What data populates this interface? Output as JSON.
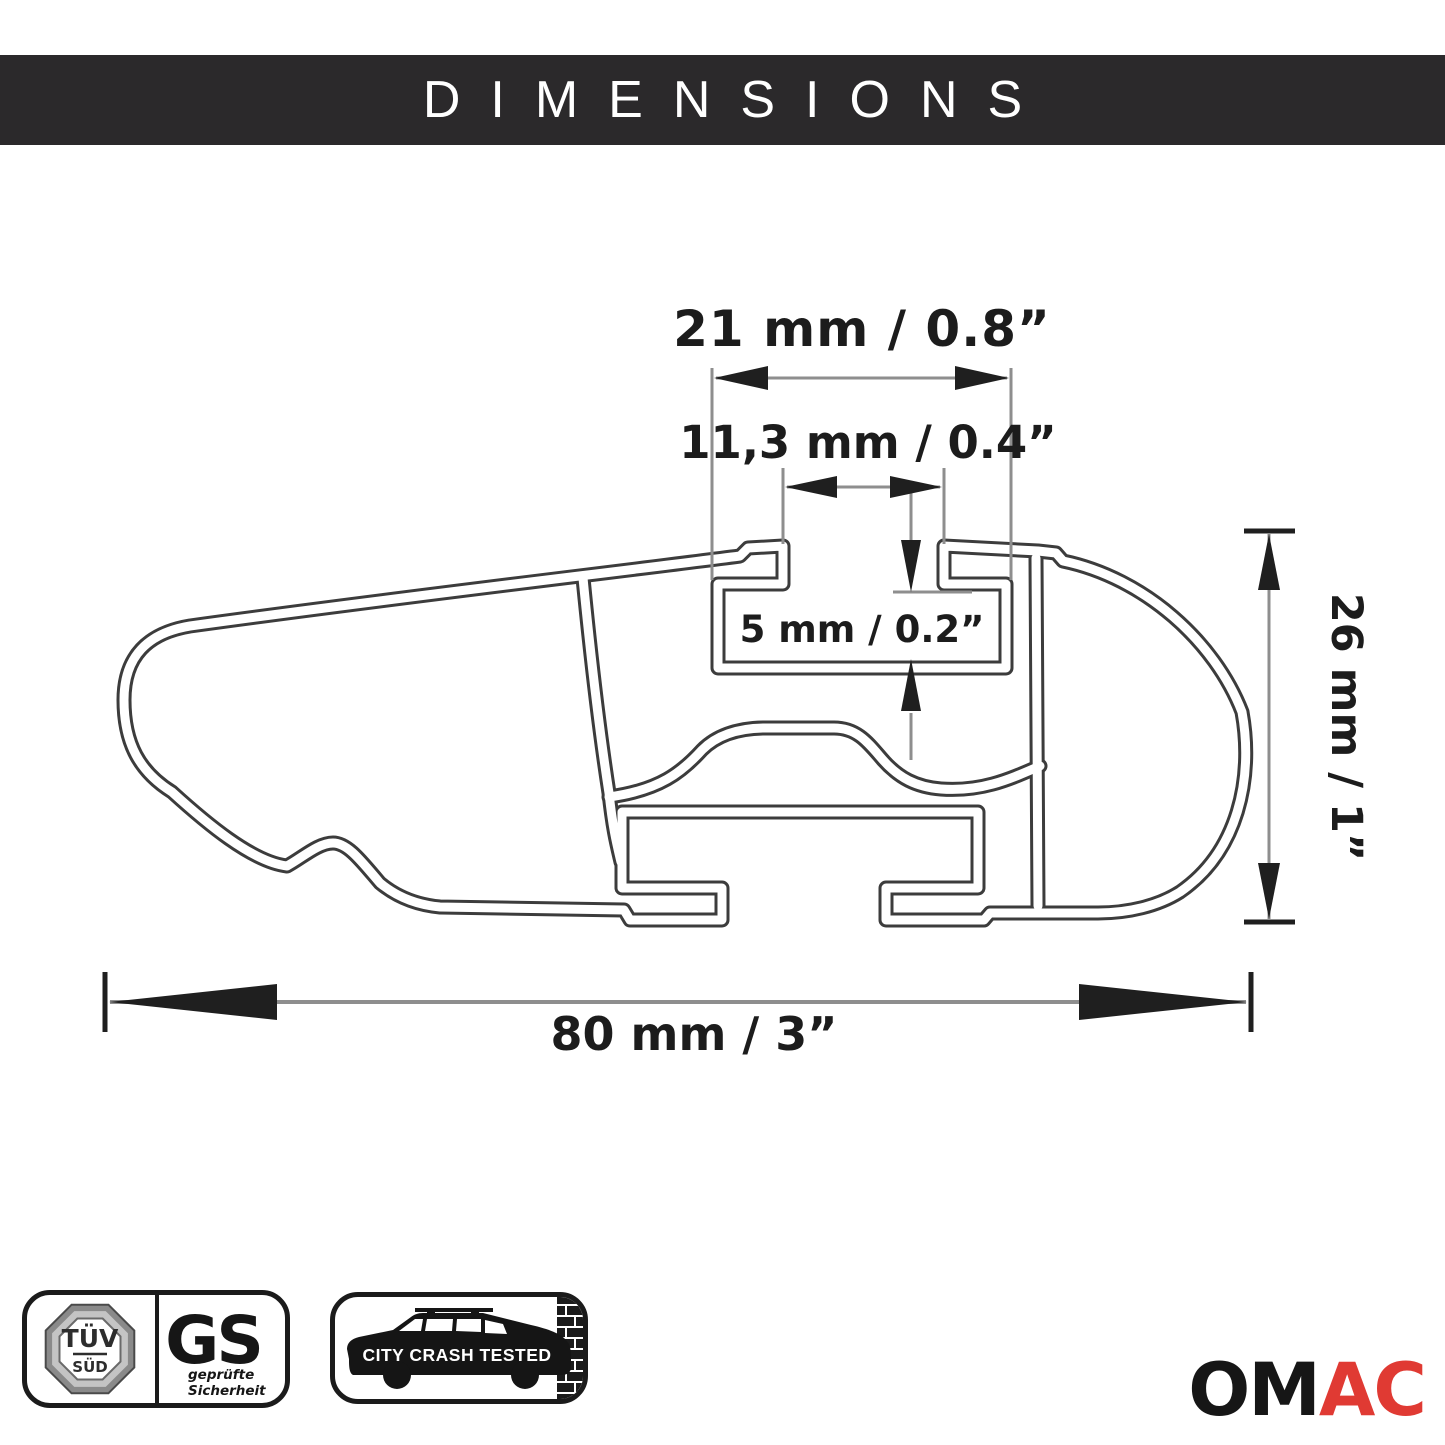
{
  "header": {
    "title": "DIMENSIONS"
  },
  "diagram": {
    "dimensions": {
      "top_width": "21 mm / 0.8”",
      "slot_opening": "11,3 mm / 0.4”",
      "slot_depth": "5 mm / 0.2”",
      "height": "26 mm / 1”",
      "total_width": "80 mm / 3”"
    },
    "line_color": "#3c3c3c",
    "dimension_line_color": "#8e8e8e",
    "arrow_color": "#1f1f1f"
  },
  "certifications": {
    "tuv": {
      "line1": "TÜV",
      "line2": "SÜD"
    },
    "gs": {
      "letters": "GS",
      "caption_line1": "geprüfte",
      "caption_line2": "Sicherheit"
    },
    "crash_test": {
      "label": "CITY CRASH TESTED"
    }
  },
  "brand": {
    "name_start": "OM",
    "name_end": "AC",
    "accent_color": "#e03a33"
  }
}
